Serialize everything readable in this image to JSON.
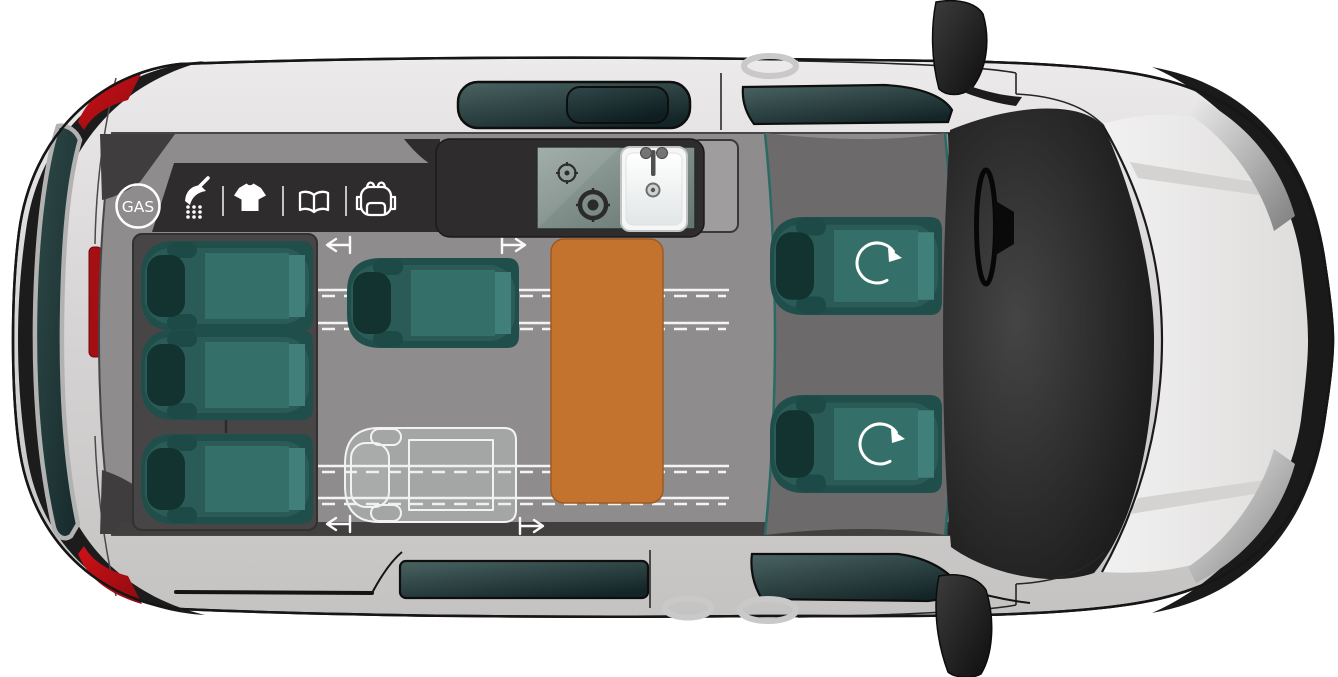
{
  "badge": {
    "label": "GAS"
  },
  "amenities": {
    "items": [
      {
        "name": "shower"
      },
      {
        "name": "tshirt"
      },
      {
        "name": "guidebook"
      },
      {
        "name": "backpack"
      }
    ]
  },
  "layout": {
    "rear_bench_seats": 3,
    "sliding_single_seats": 1,
    "optional_seat_outlines": 1,
    "swivel_front_seats": 2,
    "cooktop_burners": 2,
    "tables": 1
  },
  "colors": {
    "seat_teal": "#2a5b56",
    "seat_cushion": "#347069",
    "headrest_dark": "#12332f",
    "table_orange": "#c4732e",
    "floor_grey": "#8e8c8c",
    "cab_floor_grey": "#6d6a6b",
    "counter_charcoal": "#2f2c2d",
    "body_grey": "#d8d6d6",
    "window_slate": "#22393b",
    "tail_light_red": "#b30e13",
    "rail_white": "#f4f4f4",
    "icon_white": "#ffffff"
  }
}
